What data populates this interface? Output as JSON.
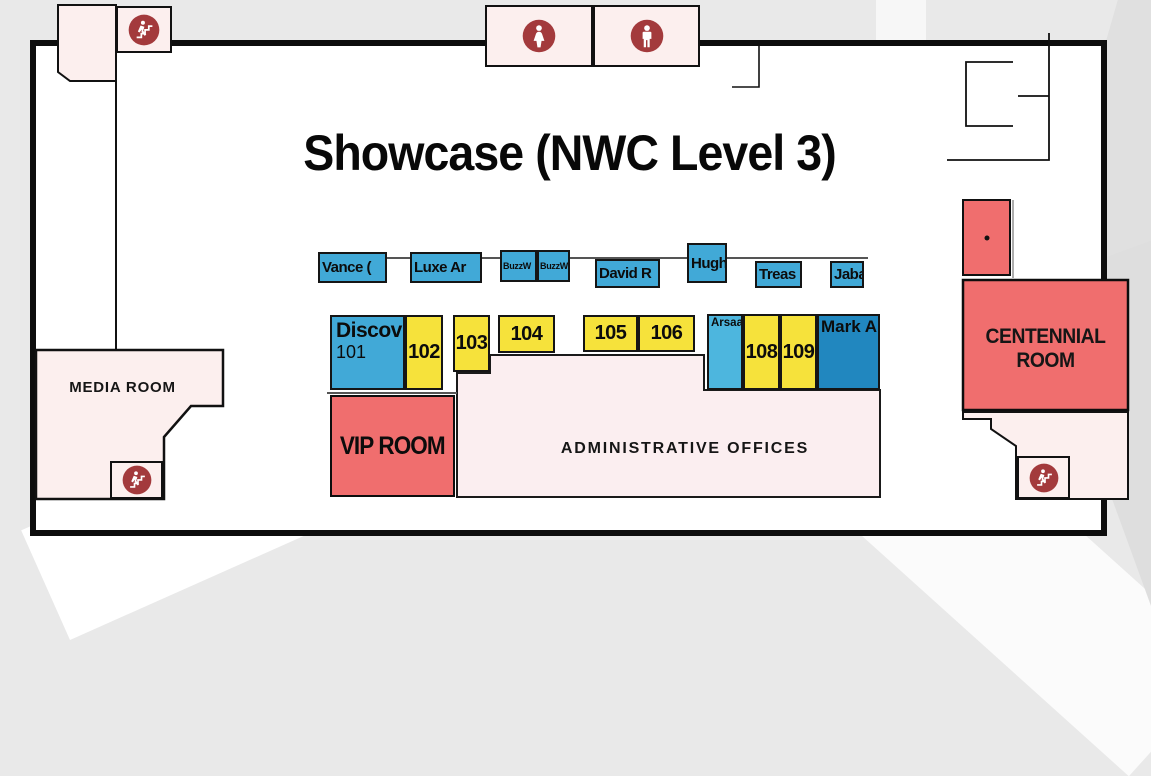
{
  "title": "Showcase (NWC Level 3)",
  "rooms": {
    "media": {
      "label": "MEDIA ROOM"
    },
    "vip": {
      "label": "VIP ROOM"
    },
    "admin": {
      "label": "ADMINISTRATIVE OFFICES"
    },
    "centennial": {
      "label": "CENTENNIAL ROOM"
    }
  },
  "booths": {
    "top_row": [
      {
        "label": "Vance (",
        "color": "#41a9d7"
      },
      {
        "label": "Luxe Ar",
        "color": "#41a9d7"
      },
      {
        "label": "BuzzW",
        "color": "#41a9d7"
      },
      {
        "label": "BuzzW",
        "color": "#41a9d7"
      },
      {
        "label": "David R",
        "color": "#41a9d7"
      },
      {
        "label": "Hughe",
        "color": "#41a9d7"
      },
      {
        "label": "Treas",
        "color": "#41a9d7"
      },
      {
        "label": "Jabar",
        "color": "#41a9d7"
      }
    ],
    "mid_row": [
      {
        "label": "Discov",
        "number": "101",
        "color": "#41a9d7"
      },
      {
        "number": "102",
        "color": "#f6e23b"
      },
      {
        "number": "103",
        "color": "#f6e23b"
      },
      {
        "number": "104",
        "color": "#f6e23b"
      },
      {
        "number": "105",
        "color": "#f6e23b"
      },
      {
        "number": "106",
        "color": "#f6e23b"
      },
      {
        "label": "Arsaa",
        "color": "#4db6de"
      },
      {
        "number": "108",
        "color": "#f6e23b"
      },
      {
        "number": "109",
        "color": "#f6e23b"
      },
      {
        "label": "Mark A",
        "color": "#2187bf"
      }
    ]
  },
  "icons": {
    "stairs_top_left": "stairs-icon",
    "stairs_bottom_left": "stairs-icon",
    "stairs_bottom_right": "stairs-icon",
    "restroom_women": "womens-restroom-icon",
    "restroom_men": "mens-restroom-icon"
  },
  "colors": {
    "booth_blue": "#41a9d7",
    "booth_blue_light": "#4db6de",
    "booth_blue_dark": "#2187bf",
    "booth_yellow": "#f6e23b",
    "room_red": "#f06e6e",
    "room_pink": "#fcefee",
    "icon_red": "#a33a3c",
    "wall_black": "#0d0d0d"
  }
}
